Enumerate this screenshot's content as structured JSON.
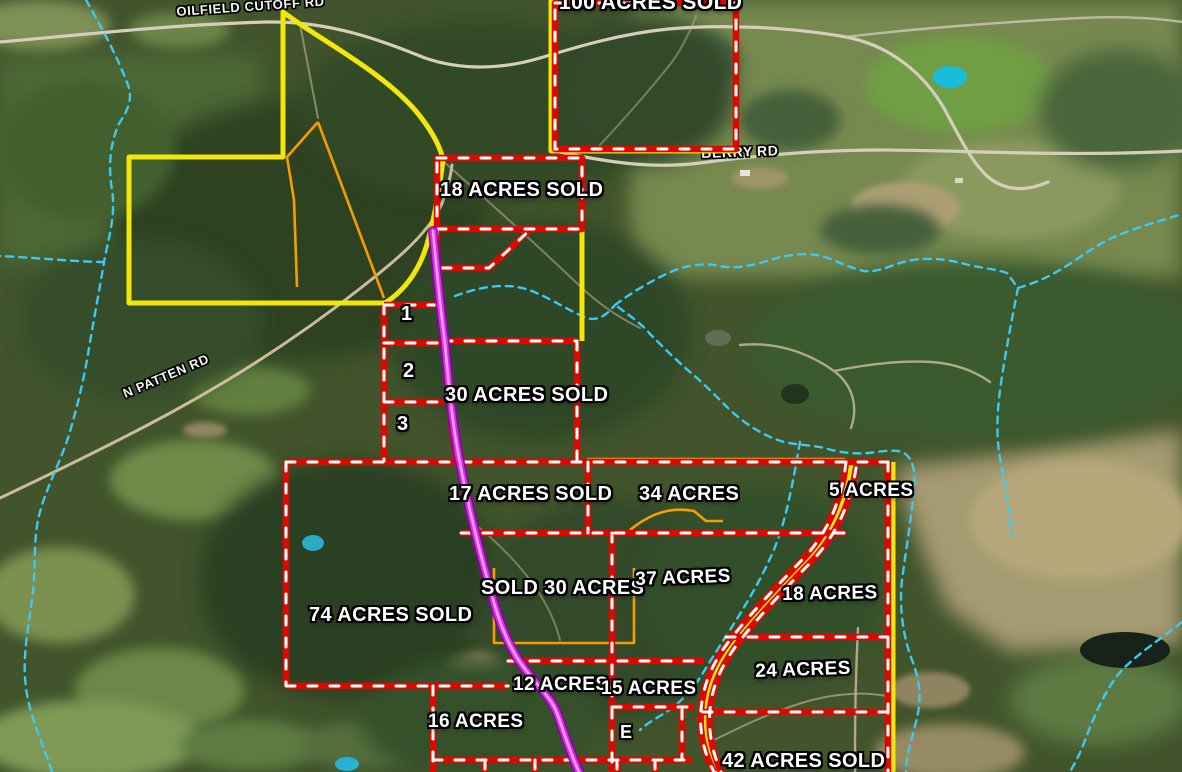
{
  "map": {
    "description": "Satellite land-parcel sales map with acreage overlays",
    "road_labels": [
      {
        "id": "oilfield-cutoff-rd",
        "text": "OILFIELD CUTOFF RD"
      },
      {
        "id": "berry-rd",
        "text": "BERRY RD"
      },
      {
        "id": "n-patten-rd",
        "text": "N PATTEN RD"
      }
    ],
    "parcel_labels": [
      {
        "id": "parcel-100-sold",
        "text": "100 ACRES SOLD"
      },
      {
        "id": "parcel-18-sold",
        "text": "18 ACRES SOLD"
      },
      {
        "id": "lot-1",
        "text": "1"
      },
      {
        "id": "lot-2",
        "text": "2"
      },
      {
        "id": "lot-3",
        "text": "3"
      },
      {
        "id": "parcel-30-sold",
        "text": "30 ACRES SOLD"
      },
      {
        "id": "parcel-17-sold",
        "text": "17 ACRES SOLD"
      },
      {
        "id": "parcel-34",
        "text": "34 ACRES"
      },
      {
        "id": "parcel-5",
        "text": "5 ACRES"
      },
      {
        "id": "parcel-sold-30",
        "text": "SOLD 30 ACRES"
      },
      {
        "id": "parcel-37",
        "text": "37 ACRES"
      },
      {
        "id": "parcel-18",
        "text": "18 ACRES"
      },
      {
        "id": "parcel-74-sold",
        "text": "74 ACRES SOLD"
      },
      {
        "id": "parcel-24",
        "text": "24 ACRES"
      },
      {
        "id": "parcel-12",
        "text": "12 ACRES"
      },
      {
        "id": "parcel-15",
        "text": "15 ACRES"
      },
      {
        "id": "parcel-16",
        "text": "16 ACRES"
      },
      {
        "id": "lot-e",
        "text": "E"
      },
      {
        "id": "parcel-42-sold",
        "text": "42 ACRES SOLD"
      }
    ],
    "overlay_colors": {
      "parcel_boundary_red": "#dd0800",
      "parcel_dash_white": "#ffffff",
      "boundary_yellow": "#f2e60a",
      "boundary_orange": "#f59e00",
      "road_highlight_magenta": "#d633e0",
      "stream_cyan": "#3ec9f2",
      "label_text": "#ffffff"
    }
  }
}
